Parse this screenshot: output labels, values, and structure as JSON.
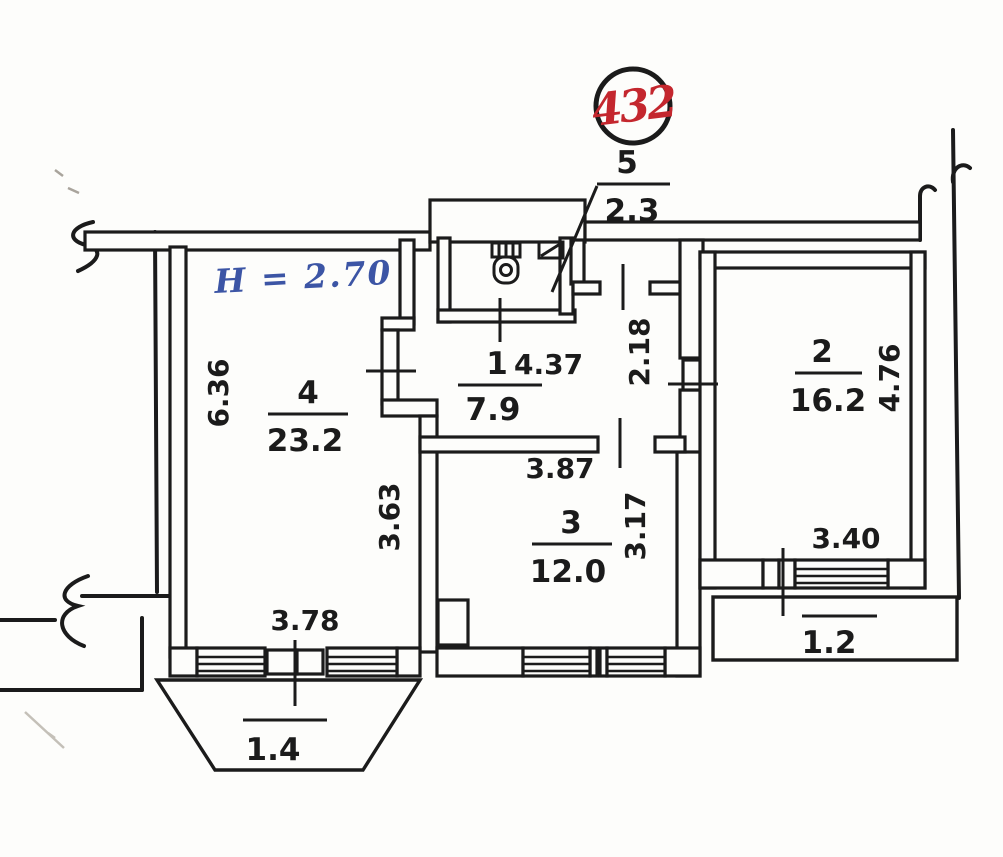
{
  "document": {
    "type": "apartment floor plan (scanned)",
    "badge": {
      "apartment_number": "432"
    },
    "notes": {
      "ceiling_height": "H = 2.70"
    },
    "rooms": {
      "r1": {
        "number": "1",
        "area": "7.9"
      },
      "r2": {
        "number": "2",
        "area": "16.2"
      },
      "r3": {
        "number": "3",
        "area": "12.0"
      },
      "r4": {
        "number": "4",
        "area": "23.2"
      },
      "r5": {
        "number": "5",
        "area": "2.3"
      }
    },
    "dims": {
      "room1_width": "4.37",
      "room4_depth": "6.36",
      "room4_inner": "3.63",
      "room4_window": "3.78",
      "balcony_left": "1.4",
      "entry_side": "2.18",
      "room3_width": "3.87",
      "room3_depth": "3.17",
      "room2_depth": "4.76",
      "room2_window": "3.40",
      "balcony_right": "1.2"
    },
    "colors": {
      "ink": "#1b1b1b",
      "badge_number": "#c4272e",
      "handwriting_blue": "#3c55a5",
      "paper": "#fdfdfb"
    }
  }
}
